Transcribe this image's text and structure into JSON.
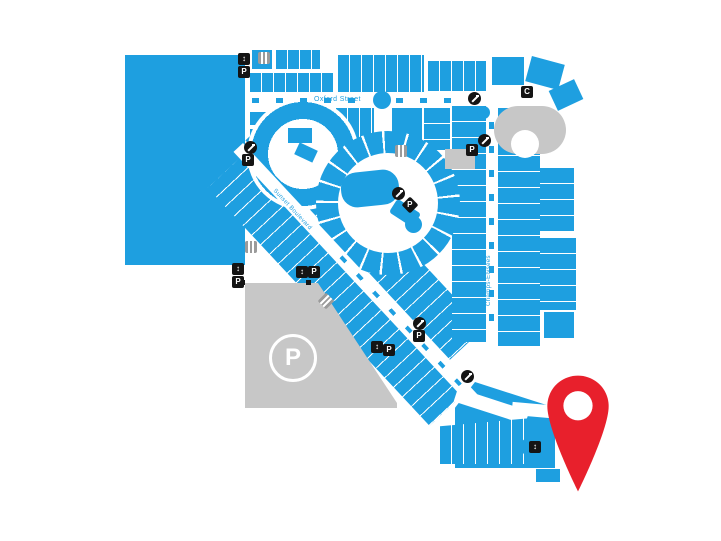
{
  "map": {
    "streets": {
      "oxford": "Oxford Street",
      "sunset": "Sunset Boulevard",
      "champs": "Champs-Élysées"
    },
    "parking_area_label": "P",
    "icon_glyphs": {
      "parking": "P",
      "lift": "↕",
      "cafe": "C"
    },
    "marker": {
      "type": "location-pin",
      "color": "#E8202C"
    },
    "colors": {
      "building_blue": "#1E9FE0",
      "street_white": "#FFFFFF",
      "parking_gray": "#C7C7C7",
      "icon_gray": "#9B9B9B",
      "icon_black": "#141414",
      "pin_red": "#E8202C",
      "label_blue": "#1E9FE0"
    }
  }
}
